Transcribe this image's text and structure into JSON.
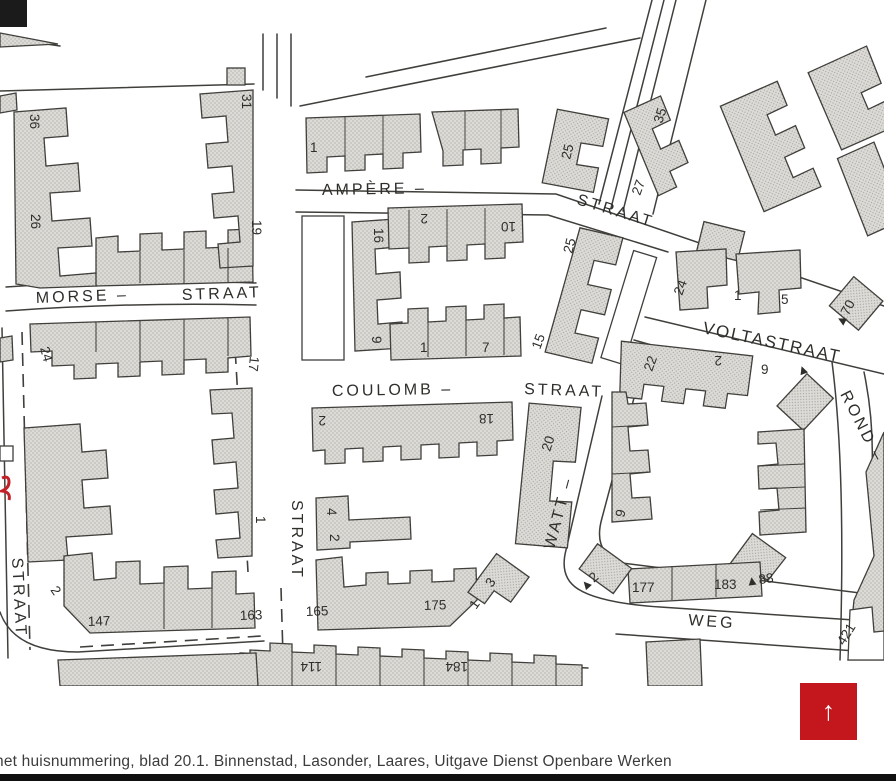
{
  "caption": {
    "text": "het huisnummering, blad 20.1. Binnenstad, Lasonder, Laares, Uitgave Dienst Openbare Werken"
  },
  "scroll_button": {
    "arrow": "↑",
    "color": "#c4161d"
  },
  "map": {
    "colors": {
      "building_fill": "#dcdbd7",
      "line": "#403f3b",
      "red_mark": "#c32028",
      "paper": "#ffffff"
    },
    "street_labels": [
      {
        "text": "AMPÈRE –"
      },
      {
        "text": "STRAAT"
      },
      {
        "text": "MORSE –"
      },
      {
        "text": "STRAAT"
      },
      {
        "text": "COULOMB –"
      },
      {
        "text": "STRAAT"
      },
      {
        "text": "VOLTASTRAAT"
      },
      {
        "text": "WATT –"
      },
      {
        "text": "WEG"
      },
      {
        "text": "STRAAT"
      },
      {
        "text": "STRAAT"
      },
      {
        "text": "ROND –"
      }
    ],
    "house_numbers": [
      {
        "text": "36"
      },
      {
        "text": "26"
      },
      {
        "text": "31"
      },
      {
        "text": "19"
      },
      {
        "text": "24"
      },
      {
        "text": "17"
      },
      {
        "text": "1"
      },
      {
        "text": "2"
      },
      {
        "text": "147"
      },
      {
        "text": "163"
      },
      {
        "text": "1"
      },
      {
        "text": "25"
      },
      {
        "text": "35"
      },
      {
        "text": "27"
      },
      {
        "text": "16"
      },
      {
        "text": "9"
      },
      {
        "text": "2"
      },
      {
        "text": "10"
      },
      {
        "text": "25"
      },
      {
        "text": "15"
      },
      {
        "text": "1"
      },
      {
        "text": "7"
      },
      {
        "text": "2"
      },
      {
        "text": "18"
      },
      {
        "text": "20"
      },
      {
        "text": "4"
      },
      {
        "text": "2"
      },
      {
        "text": "165"
      },
      {
        "text": "175"
      },
      {
        "text": "1"
      },
      {
        "text": "3"
      },
      {
        "text": "24"
      },
      {
        "text": "1"
      },
      {
        "text": "5"
      },
      {
        "text": "▲70"
      },
      {
        "text": "22"
      },
      {
        "text": "2"
      },
      {
        "text": "9"
      },
      {
        "text": "9"
      },
      {
        "text": "▲2"
      },
      {
        "text": "177"
      },
      {
        "text": "183"
      },
      {
        "text": "▲88"
      },
      {
        "text": "421"
      },
      {
        "text": "114"
      },
      {
        "text": "184"
      },
      {
        "text": "▲"
      }
    ]
  }
}
